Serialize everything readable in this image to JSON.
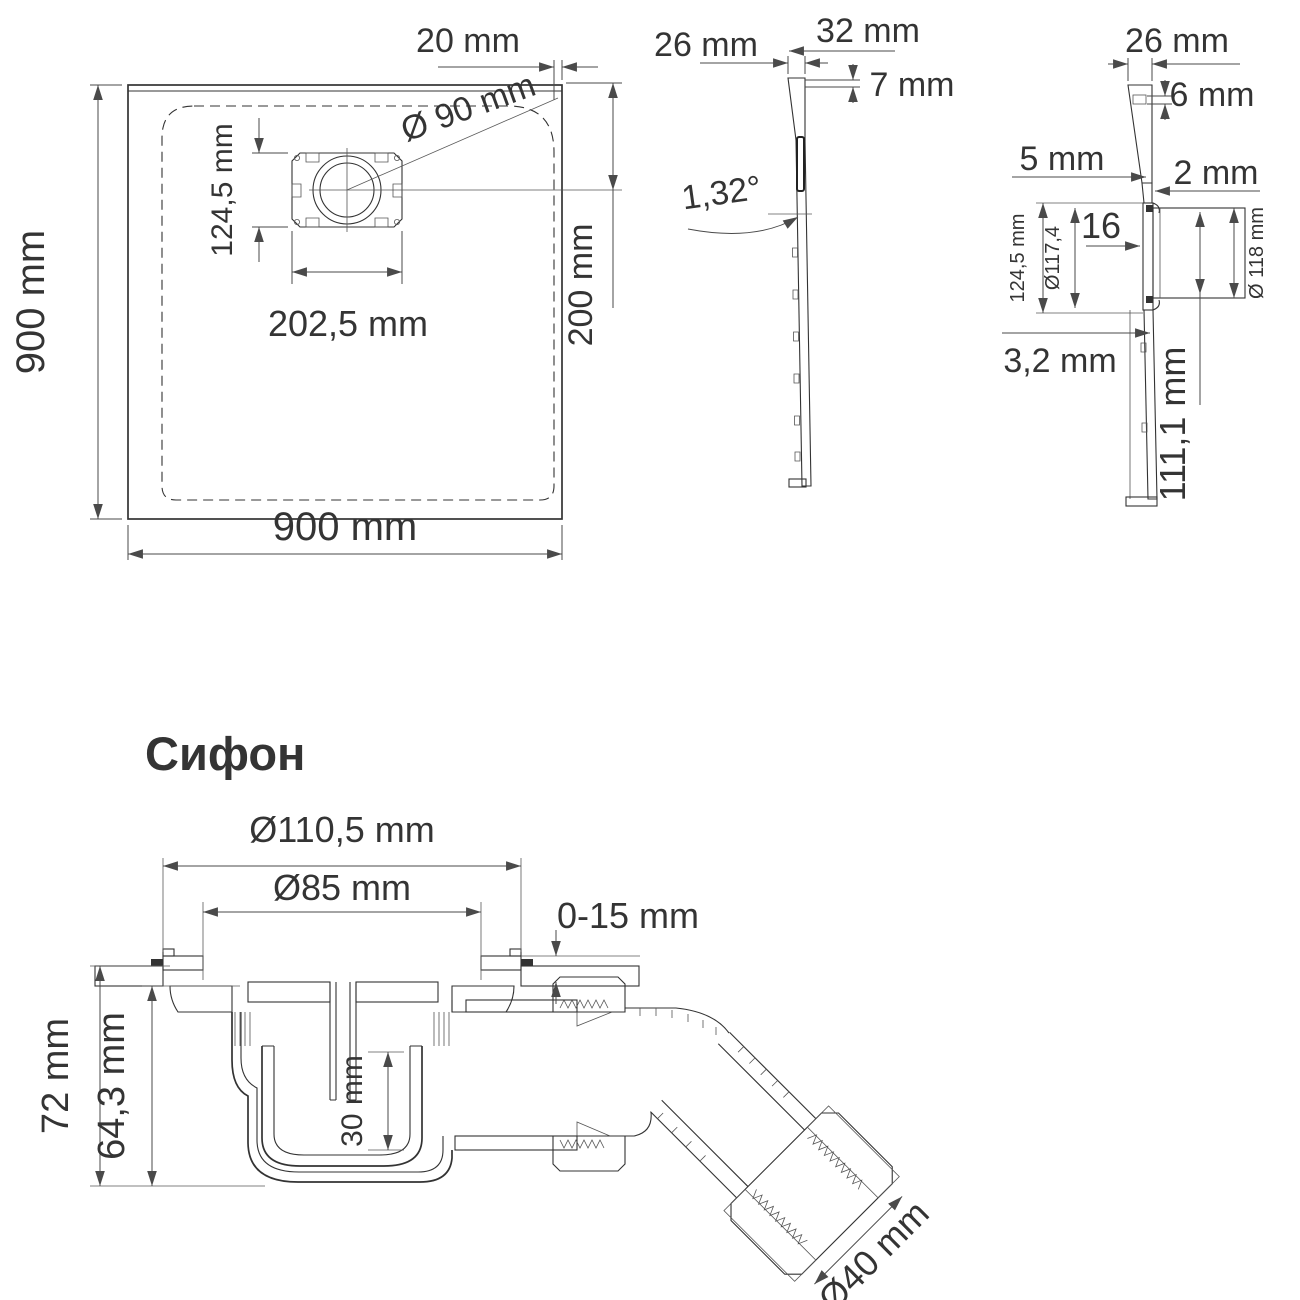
{
  "drawing": {
    "background": "#ffffff",
    "line_color": "#333333",
    "dim_color": "#4a4a4a",
    "accent_color": "#2b3a64"
  },
  "tray_top_view": {
    "label_height_left": "900 mm",
    "label_width_bottom": "900 mm",
    "label_edge_offset": "20 mm",
    "label_drain_diameter": "Ø 90 mm",
    "label_drain_box_height": "124,5 mm",
    "label_drain_box_width": "202,5 mm",
    "label_drain_center_offset": "200 mm"
  },
  "side_profile_view": {
    "label_edge_height": "26 mm",
    "label_top_width": "32 mm",
    "label_lip": "7 mm",
    "label_slope_angle": "1,32°"
  },
  "drain_profile_view": {
    "label_edge_height": "26 mm",
    "label_lip": "6 mm",
    "label_wall_upper": "5 mm",
    "label_wall_lower": "2 mm",
    "label_flange_inset": "16",
    "label_box_height": "124,5 mm",
    "label_flange_diameter": "Ø117,4",
    "label_body_diameter": "Ø 118 mm",
    "label_bottom_thickness": "3,2 mm",
    "label_body_height": "111,1 mm"
  },
  "siphon": {
    "heading": "Сифон",
    "label_flange_diameter": "Ø110,5 mm",
    "label_throat_diameter": "Ø85 mm",
    "label_adjust_range": "0-15 mm",
    "label_total_height": "72 mm",
    "label_body_height": "64,3 mm",
    "label_cup_depth": "30 mm",
    "label_outlet_diameter": "Ø40 mm"
  }
}
